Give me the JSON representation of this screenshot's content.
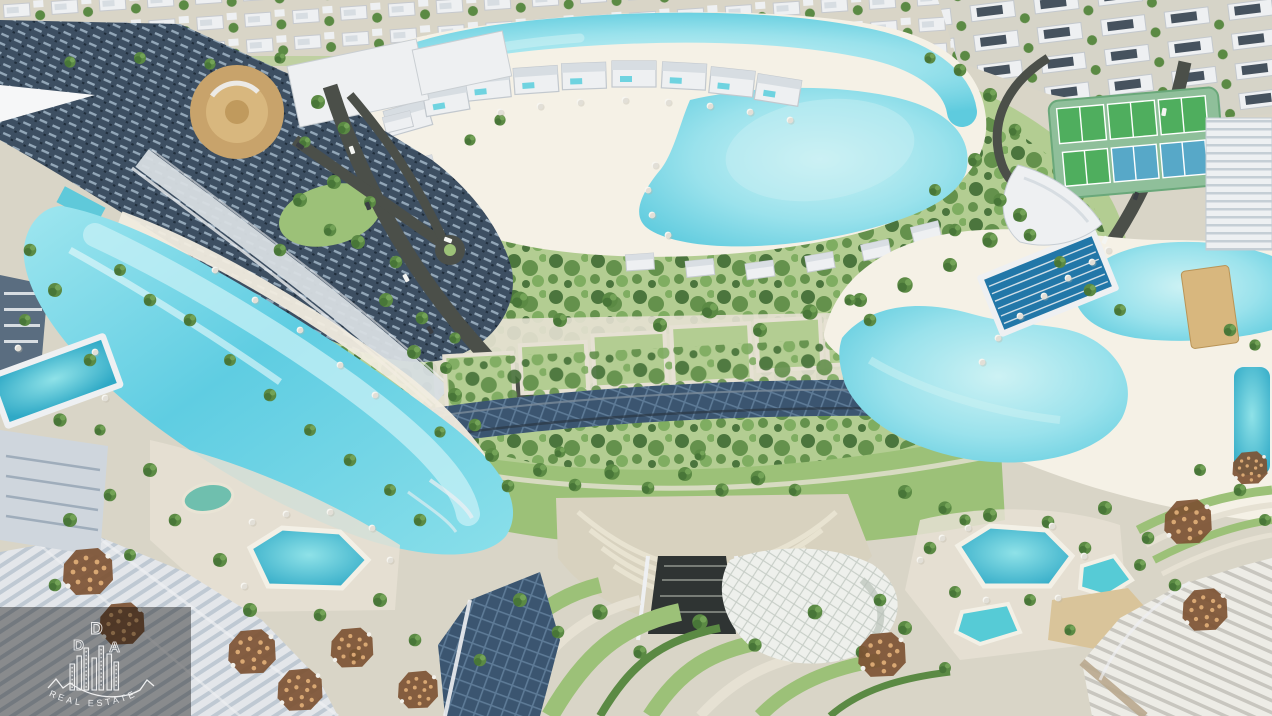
{
  "meta": {
    "type": "aerial-architectural-render",
    "subject": "Aerial 3D masterplan render of a waterfront residential community with crystal lagoons, beaches, parks, amphitheater, sports courts and towers"
  },
  "watermark": {
    "letter_top": "D",
    "letter_left": "D",
    "letter_right": "A",
    "tagline": "REAL ESTATE"
  },
  "scene": {
    "elements": [
      "top-villa-district",
      "main-beach-lagoon",
      "lagoon-shore-villas",
      "left-tower-complex",
      "round-theater-building",
      "ring-road",
      "central-tree-park",
      "garden-plots",
      "glass-promenade-roof",
      "left-river-lagoon",
      "right-wave-lagoon",
      "olympic-lap-pool",
      "tennis-court-complex",
      "amphitheater",
      "event-canopy-shell",
      "south-flowing-park",
      "southwest-pools",
      "southeast-pools",
      "bottom-left-towers",
      "bottom-right-terraced-building",
      "dda-watermark"
    ]
  },
  "colors": {
    "land": "#d9d5c7",
    "sand": "#f1ecdf",
    "beachSand": "#f5f1e6",
    "lawn": "#b3cd92",
    "lawnBright": "#9cc178",
    "treeDark": "#3f6b33",
    "tree": "#5b8a44",
    "treeLight": "#79a95c",
    "lagoon": "#8fdde9",
    "lagoonLight": "#c9f0f3",
    "lagoonDeep": "#44bcd6",
    "river": "#6fd2e4",
    "poolTeal": "#56cbd6",
    "poolBlue": "#2277a8",
    "road": "#4b4f49",
    "roadLight": "#8a8d86",
    "white": "#eef0f2",
    "buildingShadow": "#c2c9d2",
    "towerDark": "#3d4f62",
    "towerMid": "#5a6d80",
    "terrace": "#d7dde2",
    "tan": "#c8a36b",
    "tanLight": "#d8b77e",
    "deck": "#d9c49a",
    "umbrella": "#7d5233",
    "umbrellaDot": "#d9a873",
    "courtGreen": "#4fae5e",
    "courtBlue": "#57a8c8",
    "courtFrame": "#8fbf9a",
    "glass": "#3b5570",
    "glassLine": "#5d7a96",
    "canopy": "#eef0ec",
    "canopyLine": "#c6cdc6",
    "amphi": "#d8d2bf",
    "amphiLine": "#e8e3d1",
    "stone": "#e6e1d3",
    "watermark": "#ffffff",
    "watermarkBox": "#000000"
  }
}
